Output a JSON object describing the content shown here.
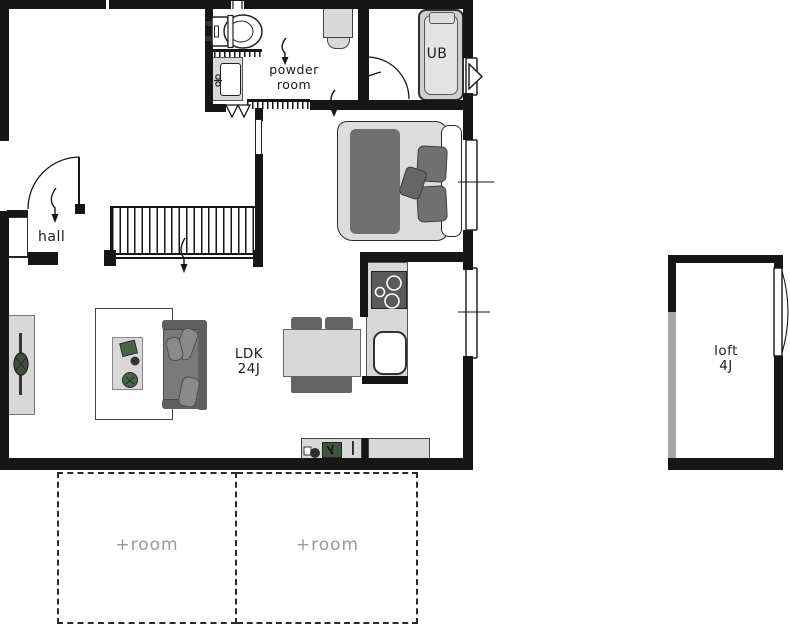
{
  "plan": {
    "type": "floor-plan",
    "rooms": {
      "powder": {
        "label": "powder\nroom"
      },
      "ub": {
        "label": "UB"
      },
      "hall": {
        "label": "hall"
      },
      "ldk": {
        "label": "LDK\n24J"
      },
      "loft": {
        "label": "loft\n4J"
      },
      "plus_left": {
        "label": "+room"
      },
      "plus_right": {
        "label": "+room"
      }
    },
    "colors": {
      "wall": "#161616",
      "lightgray": "#d8d8d8",
      "midgray": "#7a7a7a",
      "darkgray": "#646464",
      "green": "#4a634a",
      "labelgray": "#9a9a9a",
      "ink": "#1c1c1c"
    }
  }
}
